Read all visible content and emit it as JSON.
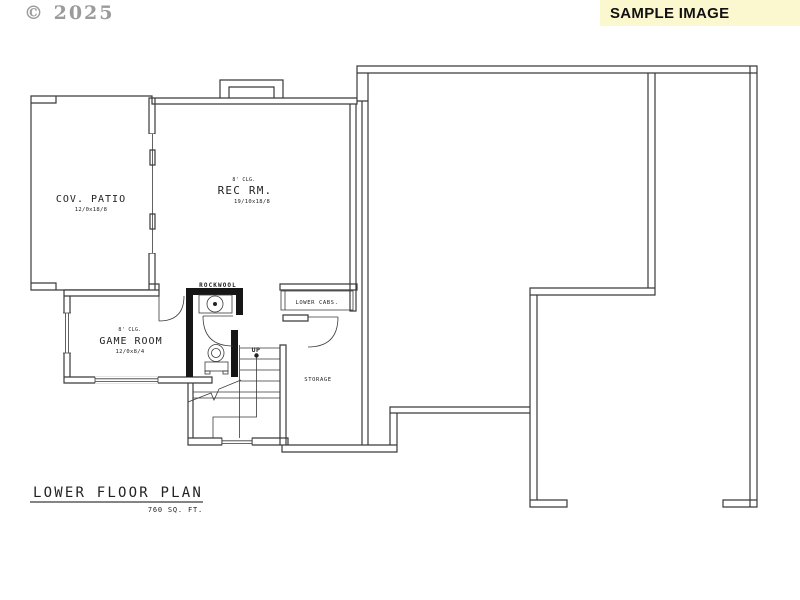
{
  "watermark": {
    "copyright": "© 2025"
  },
  "banner": {
    "label": "SAMPLE IMAGE",
    "bg_color": "#FBF8CF",
    "text_color": "#111111"
  },
  "plan": {
    "line_color": "#3a3a3a",
    "heavy_wall_color": "#161616",
    "rooms": {
      "cov_patio": {
        "name": "COV. PATIO",
        "dims": "12/0x18/8"
      },
      "rec_rm": {
        "name": "REC RM.",
        "ceiling": "8' CLG.",
        "dims": "19/10x18/8"
      },
      "game_room": {
        "name": "GAME ROOM",
        "ceiling": "8' CLG.",
        "dims": "12/0x8/4"
      },
      "storage": {
        "name": "STORAGE"
      }
    },
    "labels": {
      "rockwool": "ROCKWOOL",
      "lower_cabs": "LOWER CABS.",
      "up": "UP"
    },
    "title": {
      "text": "LOWER FLOOR PLAN",
      "area": "760 SQ. FT."
    }
  }
}
